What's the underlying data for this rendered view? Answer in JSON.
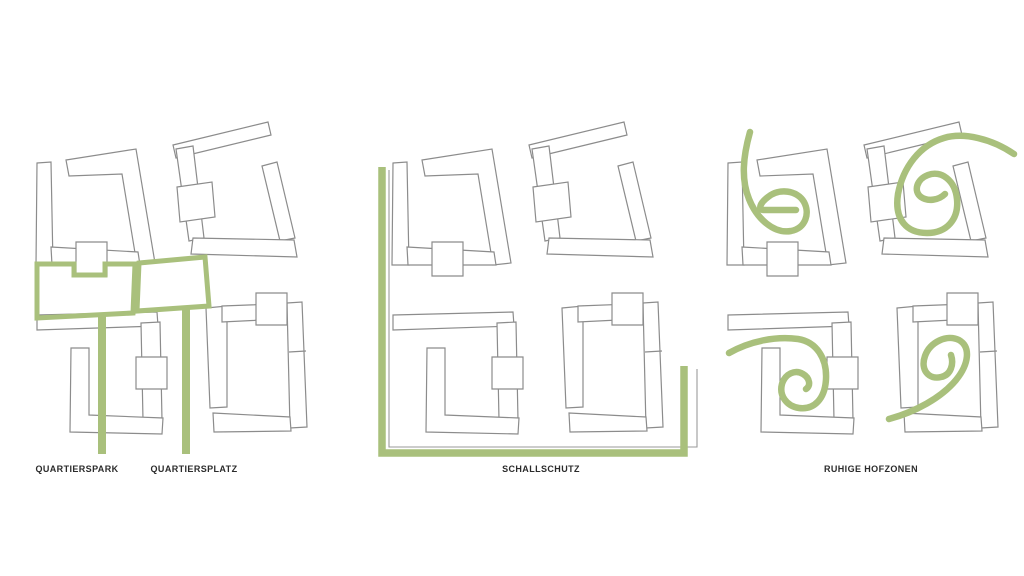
{
  "diagram": {
    "title": "urban-design-concept-diagrams",
    "background": "#ffffff",
    "building_outline_color": "#8c8c8c",
    "accent_color": "#a9c07c",
    "text_color": "#2b2b2b",
    "panels": [
      {
        "name": "quartier-open-spaces",
        "annotation": "park and plaza outlined in green with two leader lines",
        "labels": [
          "QUARTIERSPARK",
          "QUARTIERSPLATZ"
        ]
      },
      {
        "name": "noise-protection",
        "annotation": "green L-shaped barrier line along left and bottom edges",
        "labels": [
          "SCHALLSCHUTZ"
        ]
      },
      {
        "name": "quiet-courtyards",
        "annotation": "green spiral marks inside the four courtyards",
        "labels": [
          "RUHIGE HOFZONEN"
        ]
      }
    ]
  }
}
